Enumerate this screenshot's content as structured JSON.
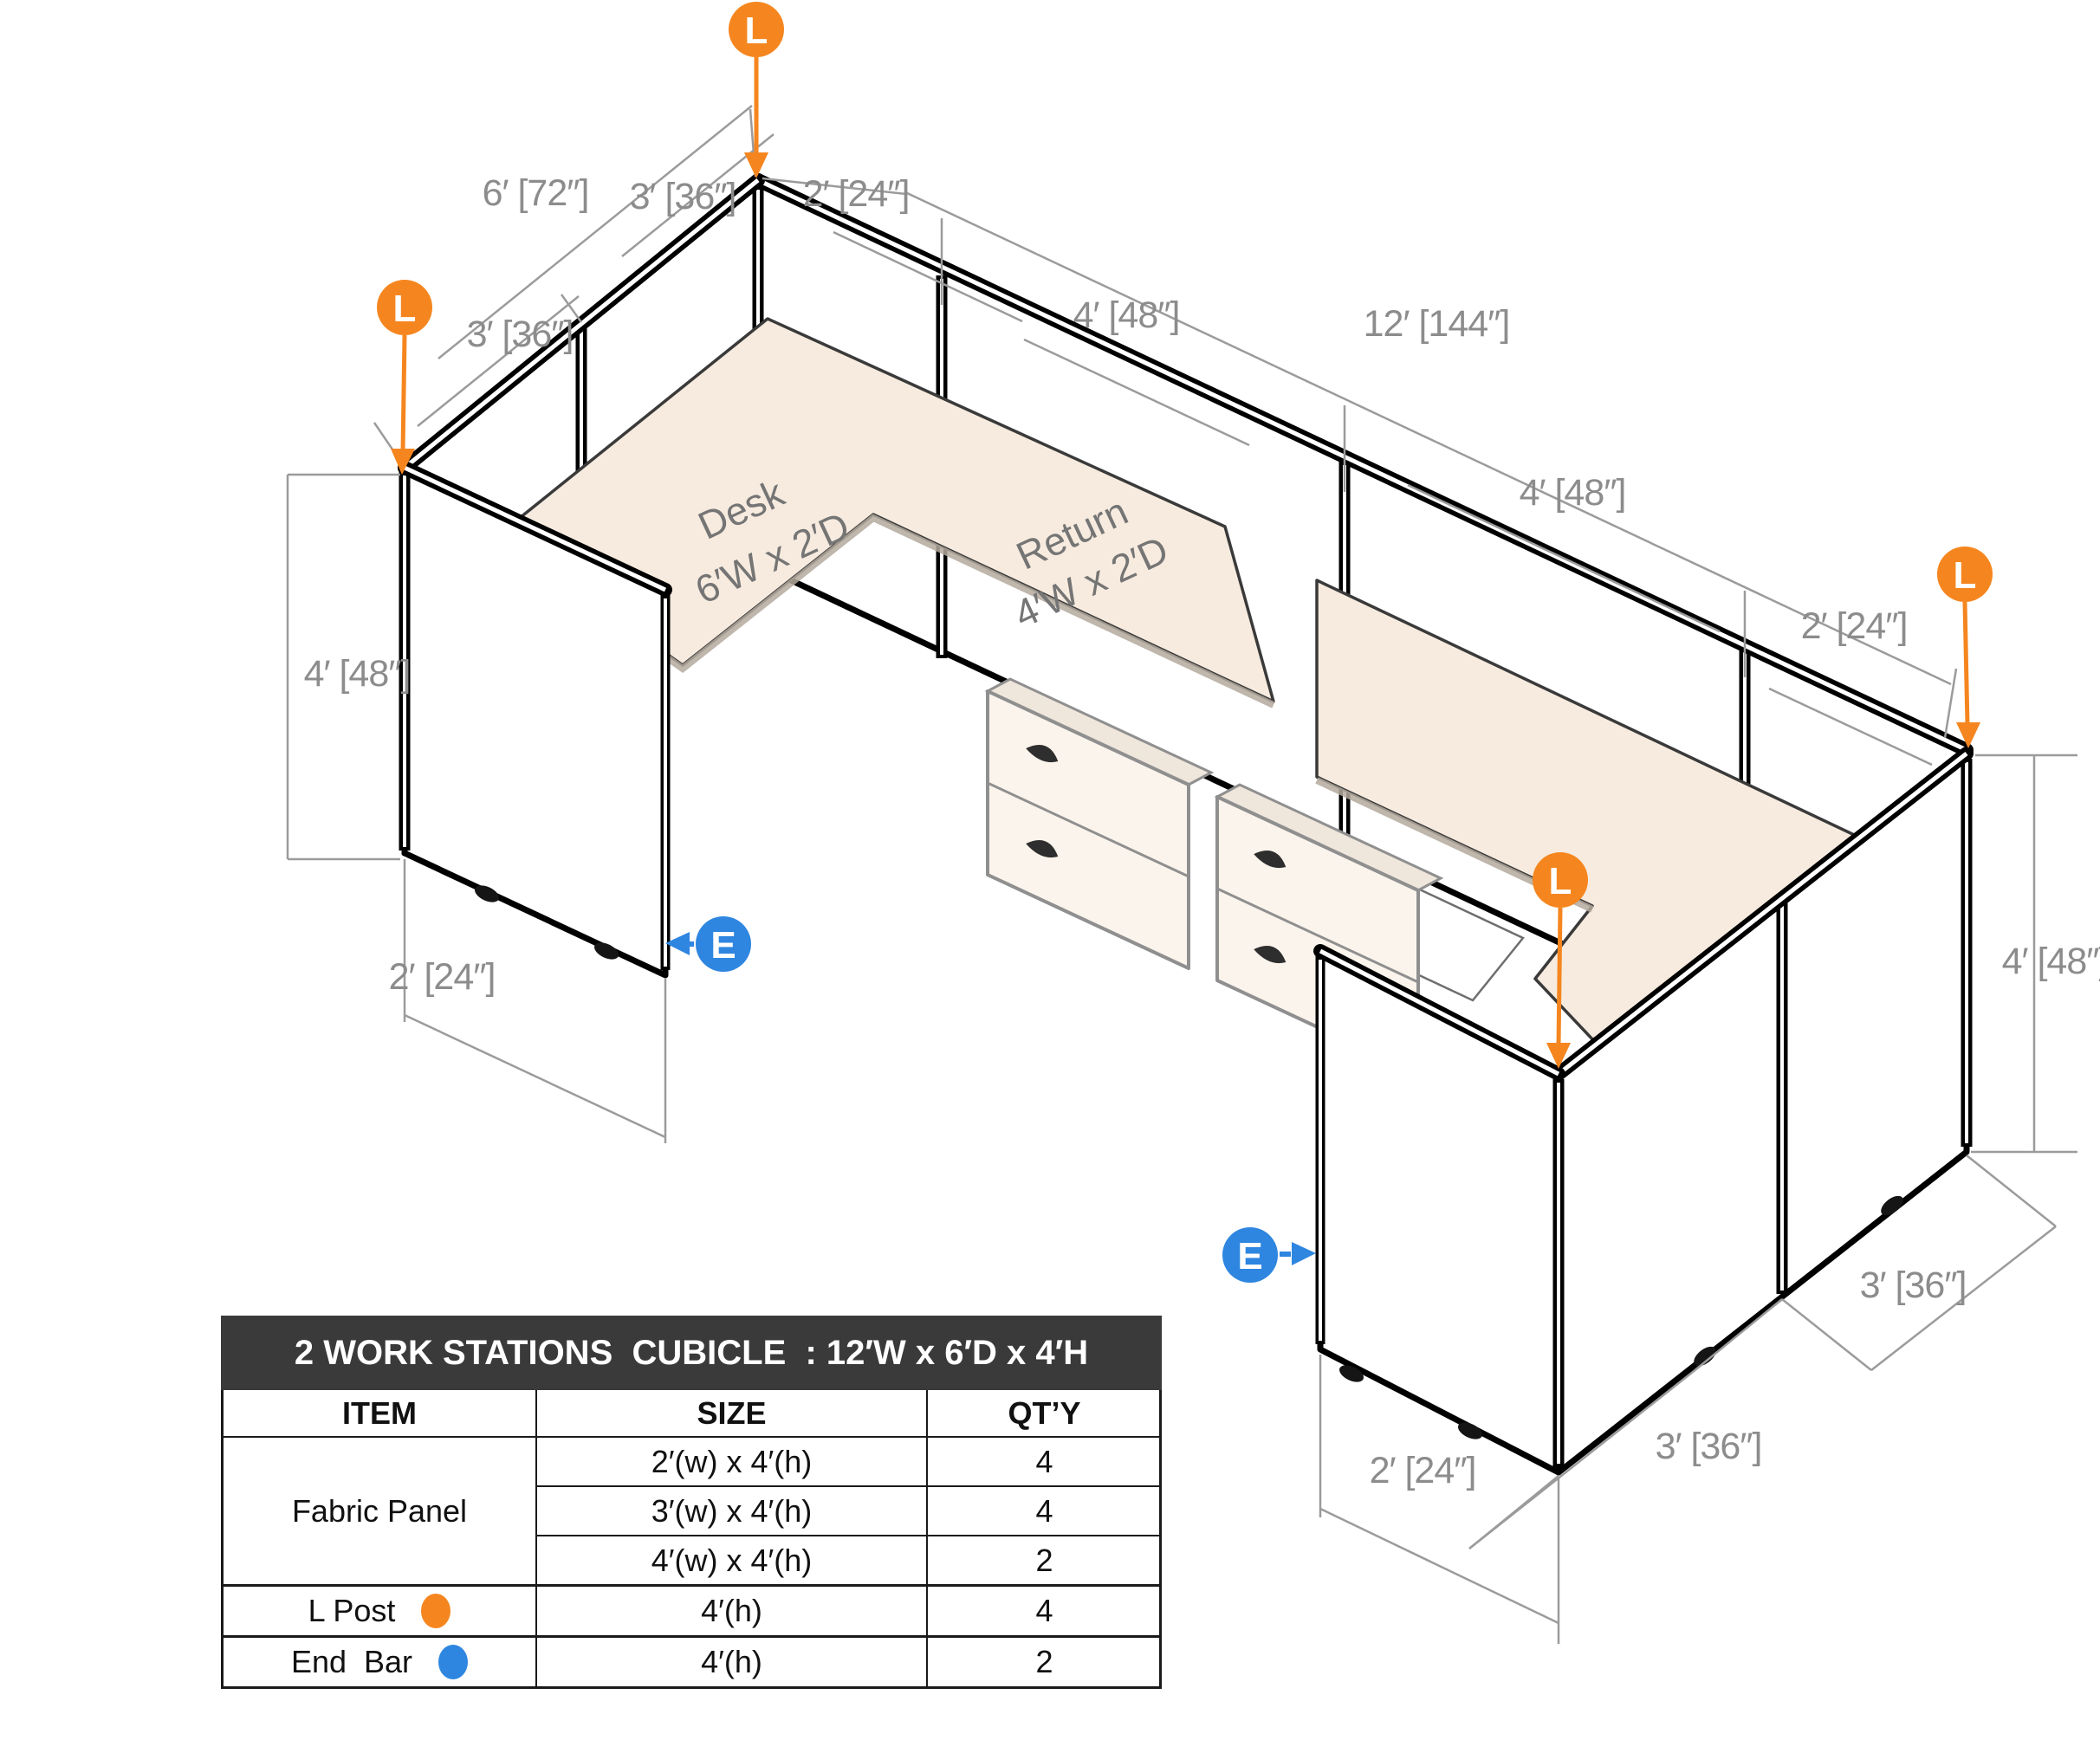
{
  "diagram": {
    "marker_l": "L",
    "marker_e": "E",
    "colors": {
      "l_post": "#F5861F",
      "end_bar": "#2E86E0",
      "dim_text": "#8c8c8c",
      "desk_surface": "#f7ebdf"
    },
    "dims": [
      "6′ [72″]",
      "3′ [36″]",
      "2′ [24″]",
      "4′ [48″]",
      "12′ [144″]",
      "3′ [36″]",
      "4′ [48″]",
      "2′ [24″]",
      "4′ [48″]",
      "2′ [24″]",
      "4′ [48″]",
      "3′ [36″]",
      "2′ [24″]",
      "3′ [36″]"
    ],
    "desk": {
      "line1": "Desk",
      "line2": "6′W x 2′D"
    },
    "return": {
      "line1": "Return",
      "line2": "4′W x 2′D"
    }
  },
  "table": {
    "title": "2 WORK STATIONS  CUBICLE  : 12′W x 6′D x 4′H",
    "columns": [
      "ITEM",
      "SIZE",
      "QT’Y"
    ],
    "items": {
      "fabric": "Fabric Panel",
      "lpost": "L Post",
      "endbar": "End  Bar"
    },
    "sizes": [
      "2′(w) x 4′(h)",
      "3′(w) x 4′(h)",
      "4′(w) x 4′(h)",
      "4′(h)",
      "4′(h)"
    ],
    "qtys": [
      "4",
      "4",
      "2",
      "4",
      "2"
    ]
  }
}
